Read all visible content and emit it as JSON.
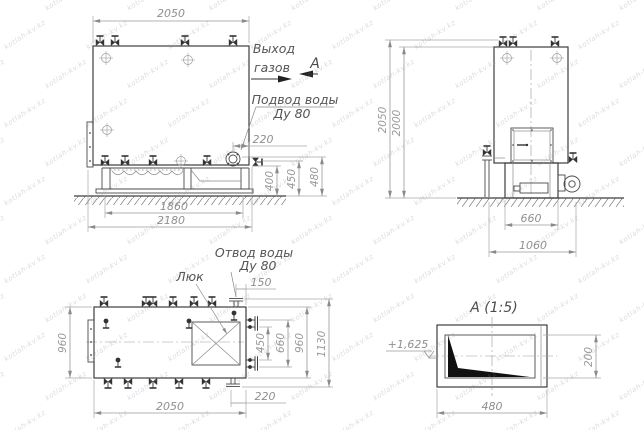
{
  "watermark": {
    "text": "kotlah-kv.kz"
  },
  "front_view": {
    "labels": {
      "gas_exit_1": "Выход",
      "gas_exit_2": "газов",
      "view_marker": "А",
      "water_inlet_1": "Подвод воды",
      "water_inlet_2": "Ду 80"
    },
    "dims": {
      "width_top": "2050",
      "flange_offset": "220",
      "h_base": "400",
      "h_valves": "450",
      "h_flange": "480",
      "base_span": "1860",
      "overall_width": "2180"
    }
  },
  "side_view": {
    "dims": {
      "height_overall": "2050",
      "height_body": "2000",
      "base_width": "660",
      "overall_width": "1060"
    }
  },
  "plan_view": {
    "labels": {
      "hatch": "Люк",
      "water_outlet_1": "Отвод воды",
      "water_outlet_2": "Ду 80"
    },
    "dims": {
      "depth_left": "960",
      "outlet_offset": "150",
      "stub_span": "450",
      "stub_overall": "660",
      "depth_right": "960",
      "overall_depth": "1130",
      "length": "2050",
      "flange_offset": "220"
    }
  },
  "detail_view": {
    "title": "А (1:5)",
    "elevation": "+1,625",
    "dims": {
      "width": "480",
      "height": "200"
    }
  }
}
